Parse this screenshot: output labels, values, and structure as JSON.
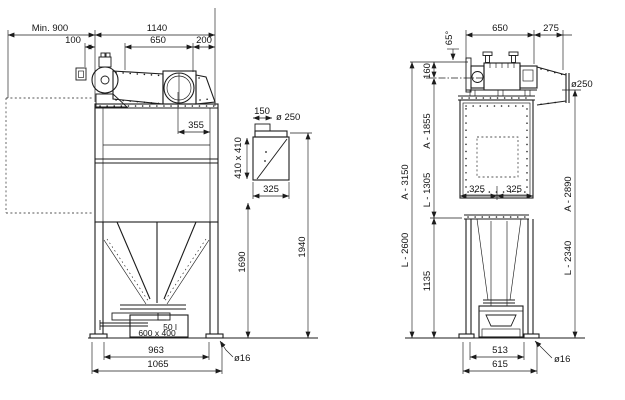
{
  "colors": {
    "line": "#1c1c1c",
    "background": "#ffffff"
  },
  "front": {
    "min_clearance": "Min. 900",
    "top_width": "1140",
    "motor_offset": "100",
    "fan_section_width": "650",
    "right_offset": "200",
    "outlet_center_offset": "355",
    "bin_capacity": "50 l",
    "bin_size": "600 x 400",
    "bolt_spacing": "963",
    "base_width": "1065",
    "anchor_hole": "ø16"
  },
  "hood": {
    "neck_width": "150",
    "duct_diameter": "ø 250",
    "body_size": "410 x 410",
    "bottom_width": "325",
    "bottom_height": "1690",
    "top_height": "1940"
  },
  "side": {
    "angle": "65°",
    "unit_width": "650",
    "diffuser_length": "275",
    "axis_offset": "160",
    "outlet_diameter": "ø250",
    "height_total_a": "A - 3150",
    "height_total_l": "L - 2600",
    "height_upper_a": "A - 1855",
    "height_upper_l": "L - 1305",
    "leg_height": "1135",
    "center_left": "325",
    "center_right": "325",
    "outlet_height_a": "A - 2890",
    "outlet_height_l": "L - 2340",
    "bolt_spacing": "513",
    "base_width": "615",
    "anchor_hole": "ø16"
  }
}
